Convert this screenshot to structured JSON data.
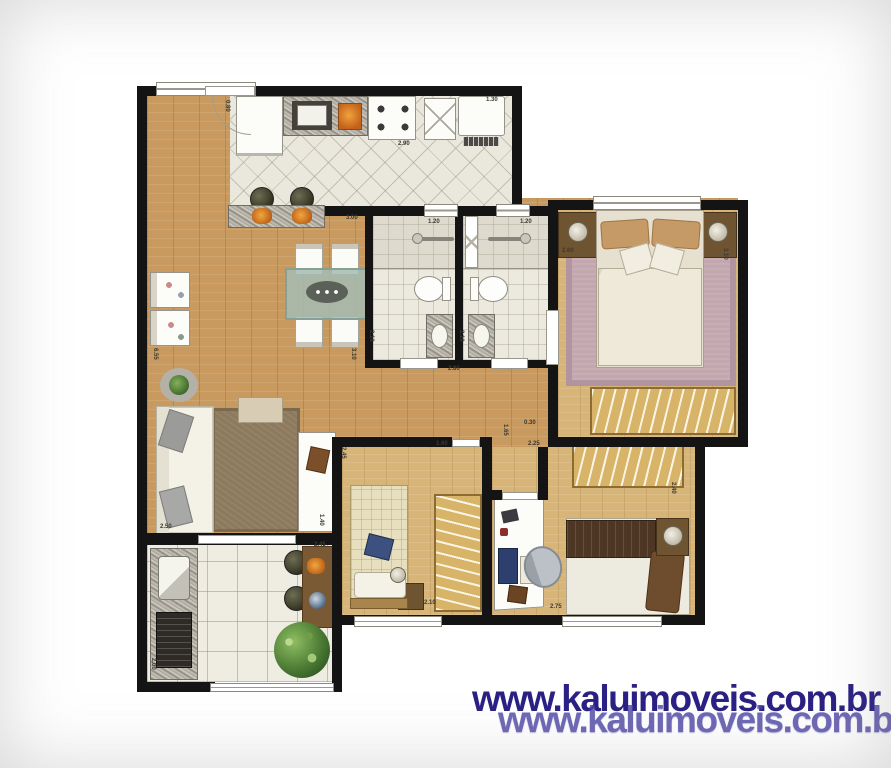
{
  "watermark": {
    "line1": "www.kaluimoveis.com.br",
    "line2": "www.kaluimoveis.com.br",
    "color_primary": "#2b2184",
    "color_reflection": "#4a43a4"
  },
  "dimensions": [
    {
      "text": "0.80",
      "x": 230,
      "y": 100,
      "vertical": true
    },
    {
      "text": "1.30",
      "x": 486,
      "y": 97,
      "vertical": false
    },
    {
      "text": "2.90",
      "x": 398,
      "y": 141,
      "vertical": false
    },
    {
      "text": "3.00",
      "x": 346,
      "y": 215,
      "vertical": false
    },
    {
      "text": "1.20",
      "x": 428,
      "y": 219,
      "vertical": false
    },
    {
      "text": "1.20",
      "x": 520,
      "y": 219,
      "vertical": false
    },
    {
      "text": "2.10",
      "x": 374,
      "y": 330,
      "vertical": true
    },
    {
      "text": "2.10",
      "x": 464,
      "y": 330,
      "vertical": true
    },
    {
      "text": "2.60",
      "x": 562,
      "y": 248,
      "vertical": false
    },
    {
      "text": "3.10",
      "x": 728,
      "y": 248,
      "vertical": true
    },
    {
      "text": "6.55",
      "x": 158,
      "y": 348,
      "vertical": true
    },
    {
      "text": "3.10",
      "x": 356,
      "y": 348,
      "vertical": true
    },
    {
      "text": "2.80",
      "x": 448,
      "y": 366,
      "vertical": false
    },
    {
      "text": "0.30",
      "x": 524,
      "y": 420,
      "vertical": false
    },
    {
      "text": "1.65",
      "x": 508,
      "y": 424,
      "vertical": true
    },
    {
      "text": "2.25",
      "x": 528,
      "y": 441,
      "vertical": false
    },
    {
      "text": "1.60",
      "x": 436,
      "y": 441,
      "vertical": false
    },
    {
      "text": "2.45",
      "x": 346,
      "y": 447,
      "vertical": true
    },
    {
      "text": "2.50",
      "x": 160,
      "y": 524,
      "vertical": false
    },
    {
      "text": "1.40",
      "x": 324,
      "y": 514,
      "vertical": true
    },
    {
      "text": "2.45",
      "x": 314,
      "y": 542,
      "vertical": false
    },
    {
      "text": "2.10",
      "x": 424,
      "y": 600,
      "vertical": false
    },
    {
      "text": "2.75",
      "x": 550,
      "y": 604,
      "vertical": false
    },
    {
      "text": "2.40",
      "x": 676,
      "y": 482,
      "vertical": true
    },
    {
      "text": "2.00",
      "x": 156,
      "y": 658,
      "vertical": true
    }
  ],
  "colors": {
    "wall": "#141414",
    "wood_living": "#c89a5f",
    "wood_bedroom": "#d7b478",
    "tile_light": "#eae7dc",
    "rug_living": "#8d7a5e",
    "rug_master": "#c3a7ae",
    "wardrobe": "#d8b469",
    "watermark": "#2b2184"
  }
}
